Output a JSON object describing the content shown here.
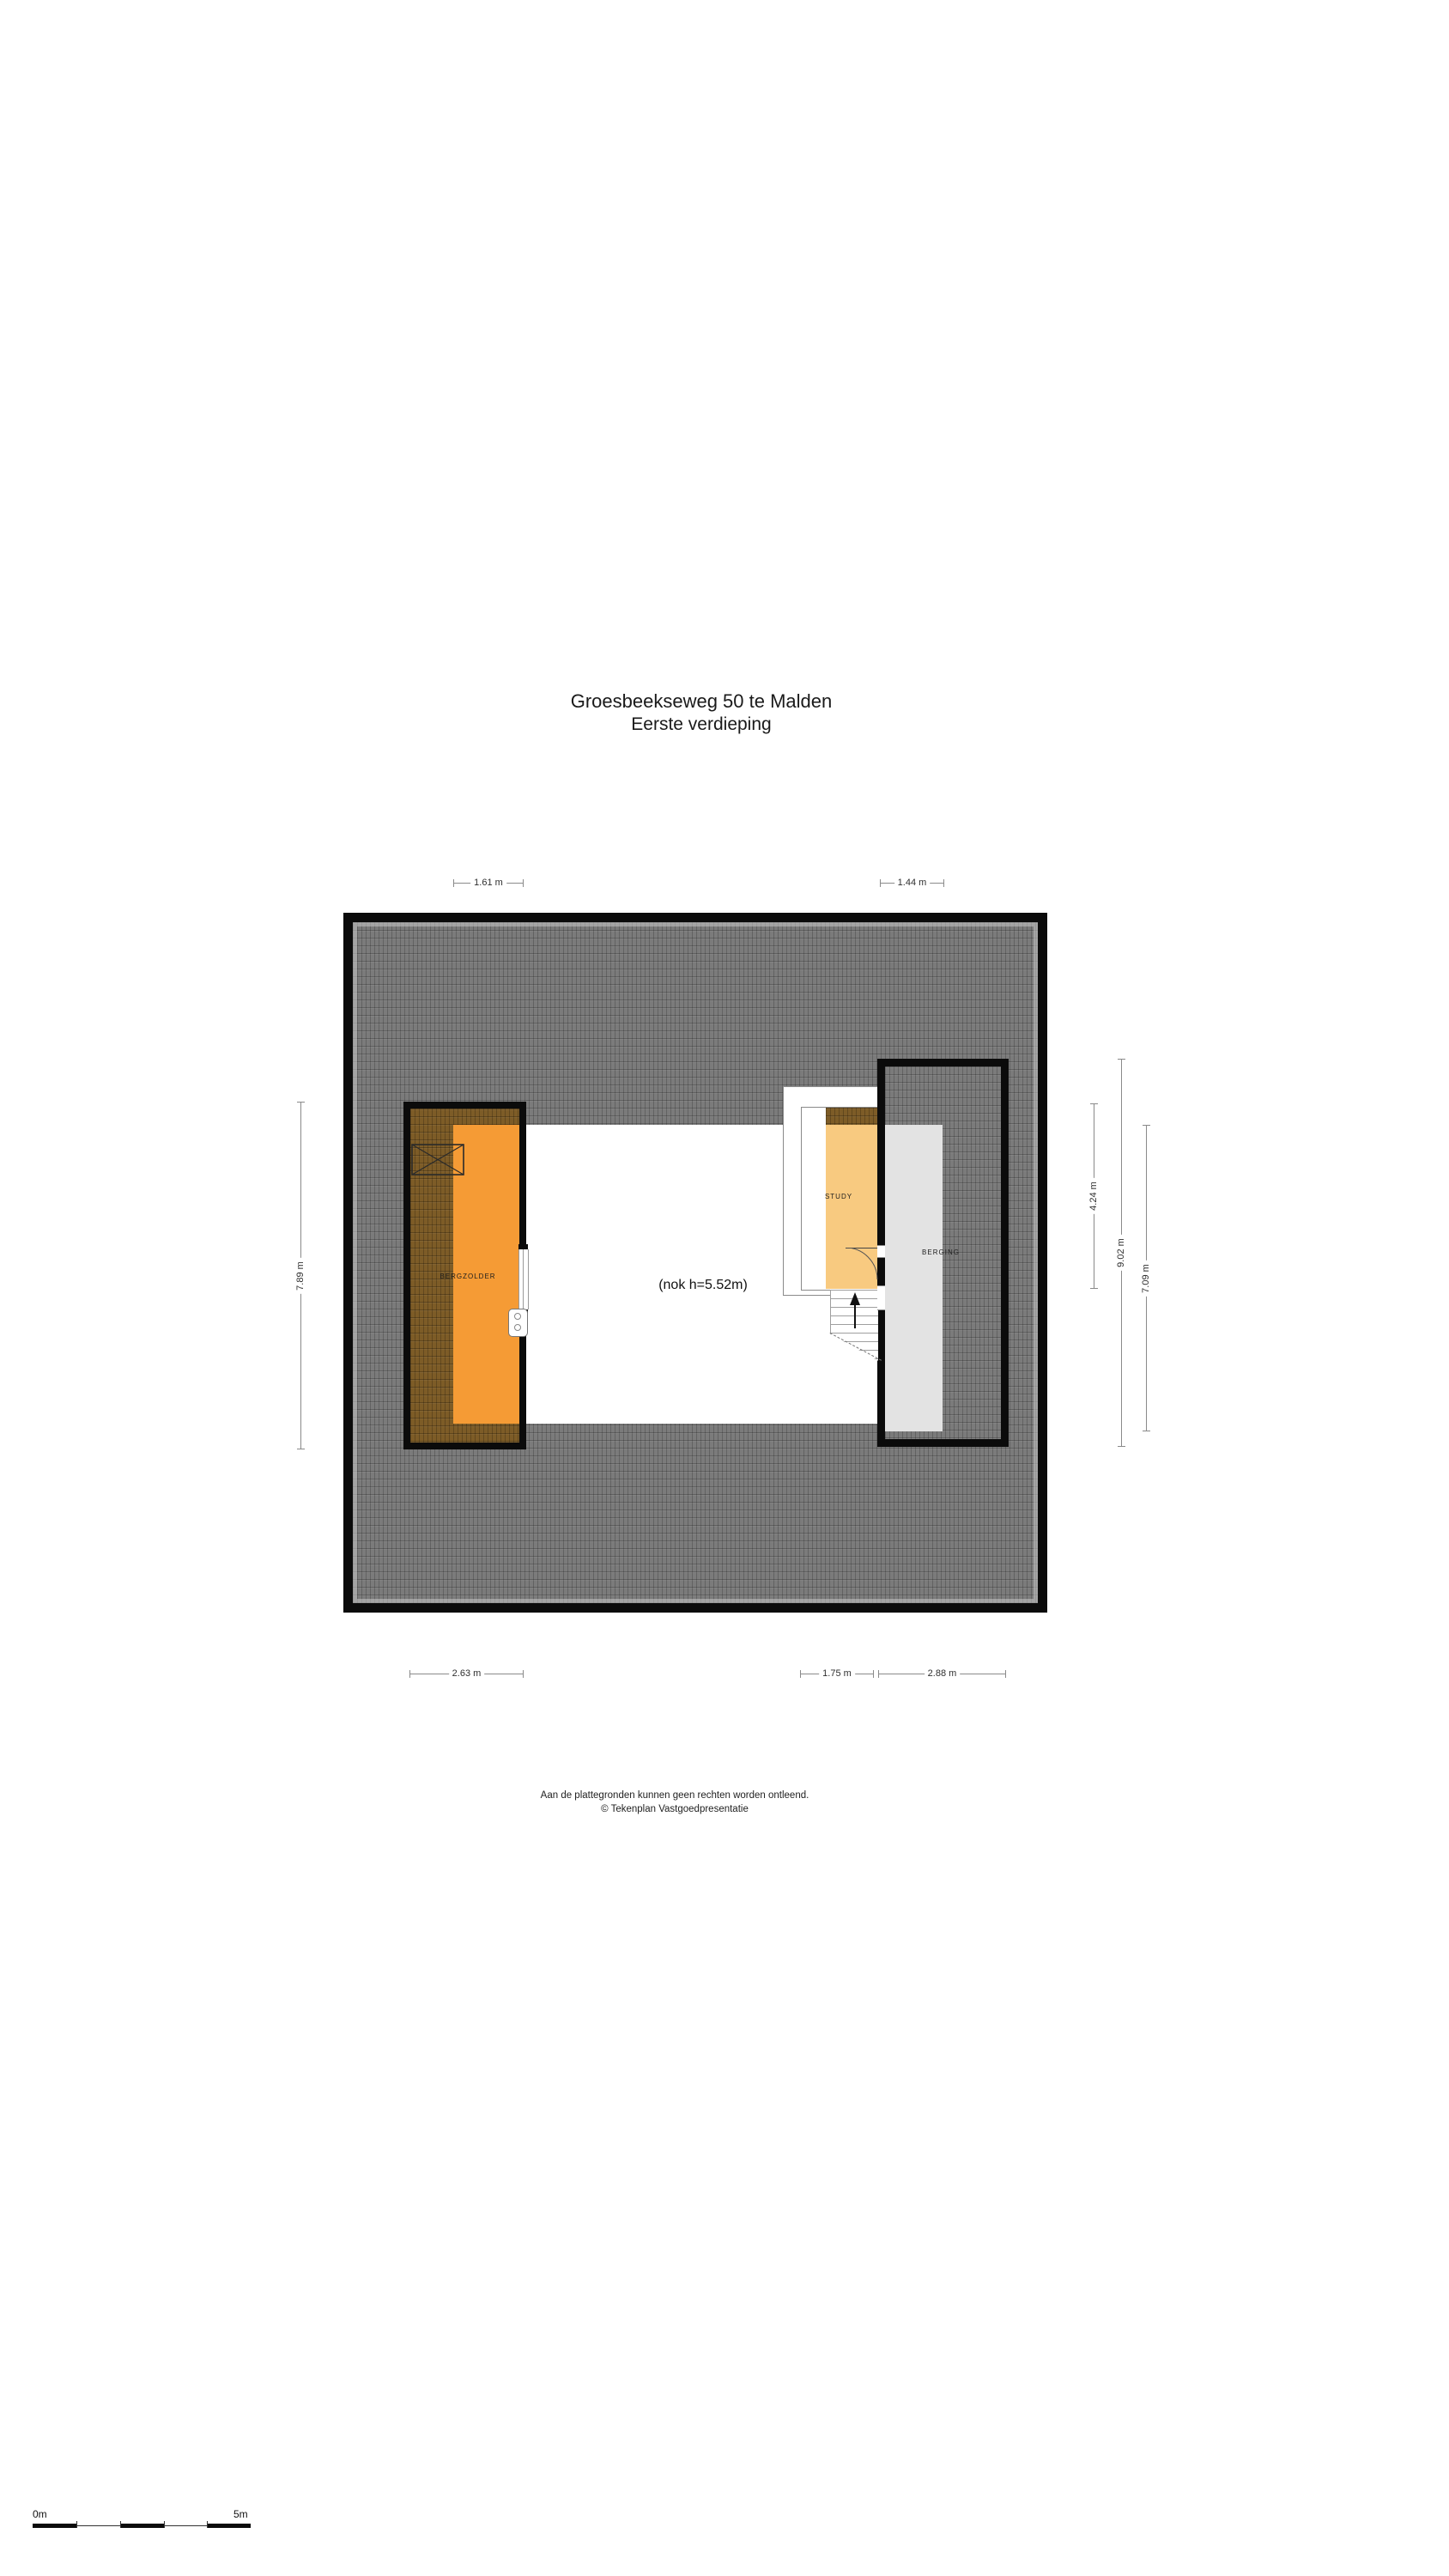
{
  "title": {
    "line1": "Groesbeekseweg 50 te Malden",
    "line2": "Eerste verdieping"
  },
  "rooms": {
    "bergzolder": "BERGZOLDER",
    "study": "STUDY",
    "berging": "BERGING"
  },
  "annotations": {
    "ridge_height": "(nok h=5.52m)"
  },
  "dimensions": {
    "top_left": "1.61 m",
    "top_right": "1.44 m",
    "bottom_left": "2.63 m",
    "bottom_mid": "1.75 m",
    "bottom_right": "2.88 m",
    "left_side": "7.89 m",
    "right_inner": "4.24 m",
    "right_mid": "9.02 m",
    "right_outer": "7.09 m"
  },
  "footer": {
    "line1": "Aan de plattegronden kunnen geen rechten worden ontleend.",
    "line2": "© Tekenplan Vastgoedpresentatie"
  },
  "scalebar": {
    "start_label": "0m",
    "end_label": "5m"
  },
  "colors": {
    "roof_gray": "#7b7b7b",
    "roof_brown": "#7d5c27",
    "wall_black": "#0b0b0b",
    "bergzolder_orange": "#f59b35",
    "study_orange": "#f8ca80",
    "berging_gray": "#e3e3e3",
    "dimension_line": "#8a8a8a"
  }
}
